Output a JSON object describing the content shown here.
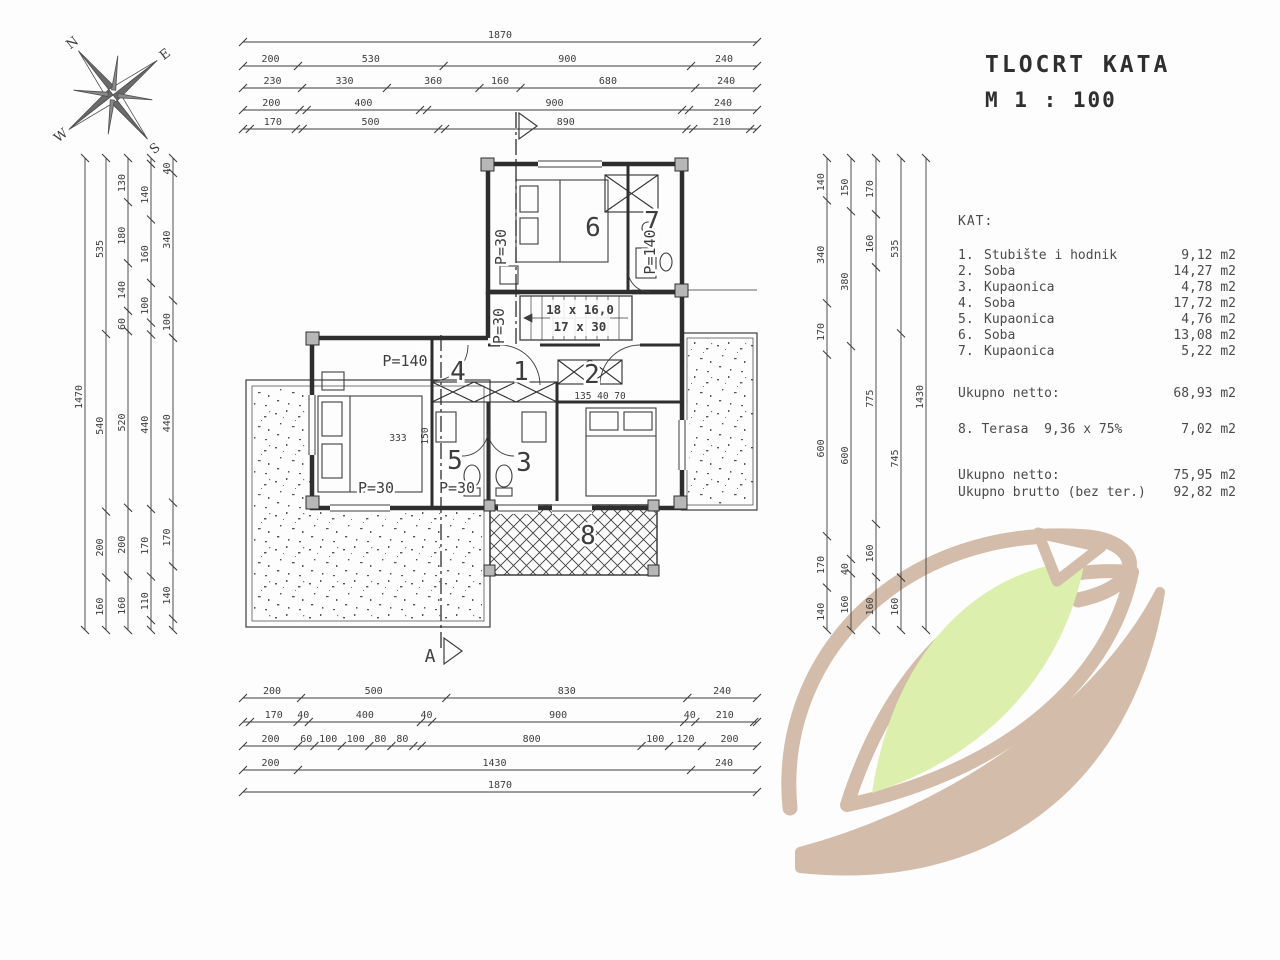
{
  "title": {
    "line1": "TLOCRT KATA",
    "line2": "M 1 : 100"
  },
  "legend": {
    "header": "KAT:",
    "rooms": [
      {
        "no": "1.",
        "name": "Stubište i hodnik",
        "area": "9,12 m2"
      },
      {
        "no": "2.",
        "name": "Soba",
        "area": "14,27 m2"
      },
      {
        "no": "3.",
        "name": "Kupaonica",
        "area": "4,78 m2"
      },
      {
        "no": "4.",
        "name": "Soba",
        "area": "17,72 m2"
      },
      {
        "no": "5.",
        "name": "Kupaonica",
        "area": "4,76 m2"
      },
      {
        "no": "6.",
        "name": "Soba",
        "area": "13,08 m2"
      },
      {
        "no": "7.",
        "name": "Kupaonica",
        "area": "5,22 m2"
      }
    ],
    "totals": [
      {
        "label": "Ukupno netto:",
        "value": "68,93 m2"
      },
      {
        "label": "8. Terasa  9,36 x 75%",
        "value": "7,02 m2"
      },
      {
        "label": "Ukupno netto:",
        "value": "75,95 m2"
      },
      {
        "label": "Ukupno brutto (bez ter.)",
        "value": "92,82 m2"
      }
    ]
  },
  "plan": {
    "rooms": [
      "1",
      "2",
      "3",
      "4",
      "5",
      "6",
      "7",
      "8"
    ],
    "labels": {
      "p140_mid": "P=140",
      "p30_bed": "P=30",
      "p30_bath": "P=30",
      "p30_room6": "P=30",
      "p140_room7": "P=140",
      "p30_stair": "P=30",
      "stair_line1": "18 x 16,0",
      "stair_line2": "17 x 30",
      "dims_small": "135  40  70",
      "dim_150": "150",
      "bed_marks": "333",
      "section_letter": "A"
    }
  },
  "compass": {
    "n": "N",
    "e": "E",
    "s": "S",
    "w": "W"
  },
  "dims": {
    "top": [
      [
        "1870"
      ],
      [
        "200",
        "530",
        "900",
        "240"
      ],
      [
        "230",
        "330",
        "360",
        "160",
        "680",
        "240"
      ],
      [
        "200",
        "25",
        "400",
        "25",
        "900",
        "25",
        "240"
      ],
      [
        "25",
        "170",
        "25",
        "500",
        "25",
        "890",
        "25",
        "210",
        "25"
      ]
    ],
    "bottom": [
      [
        "200",
        "500",
        "830",
        "240"
      ],
      [
        "25",
        "170",
        "40",
        "400",
        "40",
        "900",
        "40",
        "210",
        "10"
      ],
      [
        "200",
        "60",
        "100",
        "100",
        "80",
        "80",
        "30",
        "800",
        "100",
        "120",
        "200"
      ],
      [
        "200",
        "1430",
        "240"
      ],
      [
        "1870"
      ]
    ],
    "left": [
      [
        "1470"
      ],
      [
        "535",
        "540",
        "200",
        "160"
      ],
      [
        "130",
        "180",
        "140",
        "60",
        "520",
        "200",
        "160"
      ],
      [
        "15",
        "140",
        "160",
        "100",
        "30",
        "440",
        "170",
        "110",
        "25"
      ],
      [
        "40",
        "340",
        "100",
        "440",
        "170",
        "140",
        "30"
      ]
    ],
    "right": [
      [
        "140",
        "340",
        "170",
        "600",
        "170",
        "140"
      ],
      [
        "150",
        "380",
        "600",
        "40",
        "160"
      ],
      [
        "170",
        "160",
        "775",
        "160",
        "160"
      ],
      [
        "535",
        "745",
        "160"
      ],
      [
        "1430"
      ]
    ]
  },
  "colors": {
    "ink": "#3d3d3d",
    "wall": "#2e2e2e",
    "watermark_tan": "#d3bdaa",
    "watermark_green": "#dcefac"
  }
}
